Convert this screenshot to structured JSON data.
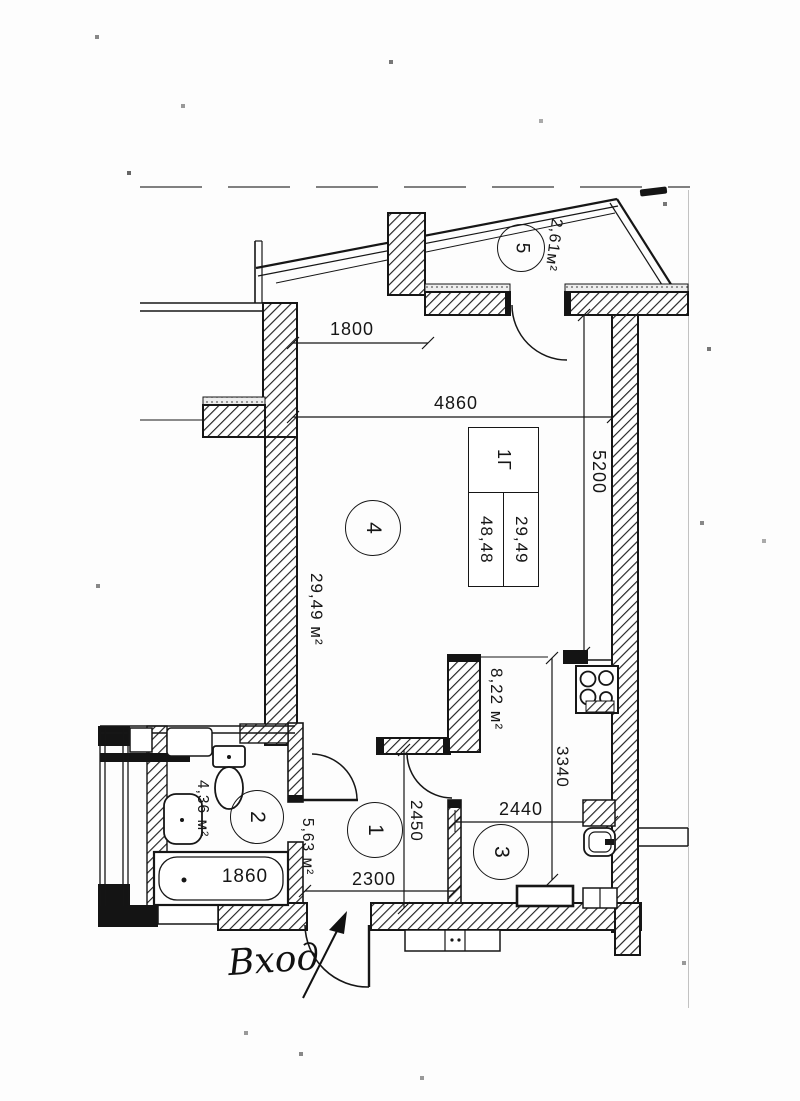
{
  "rooms": [
    {
      "number": "1",
      "area": "5,63 м²"
    },
    {
      "number": "2",
      "area": "4,36 м²"
    },
    {
      "number": "3",
      "area": "8,22 м²"
    },
    {
      "number": "4",
      "area": "29,49 м²"
    },
    {
      "number": "5",
      "area": "2,61м²"
    }
  ],
  "stamp": {
    "type": "1Г",
    "living_area": "29,49",
    "total_area": "48,48"
  },
  "dims": {
    "wall_1800": "1800",
    "wall_4860": "4860",
    "wall_5200": "5200",
    "wall_3340": "3340",
    "wall_2450": "2450",
    "wall_2300": "2300",
    "wall_2440": "2440",
    "tub_1860": "1860"
  },
  "labels": {
    "entrance": "Вход"
  },
  "colors": {
    "ink": "#1c1c1c",
    "paper": "#ffffff"
  }
}
